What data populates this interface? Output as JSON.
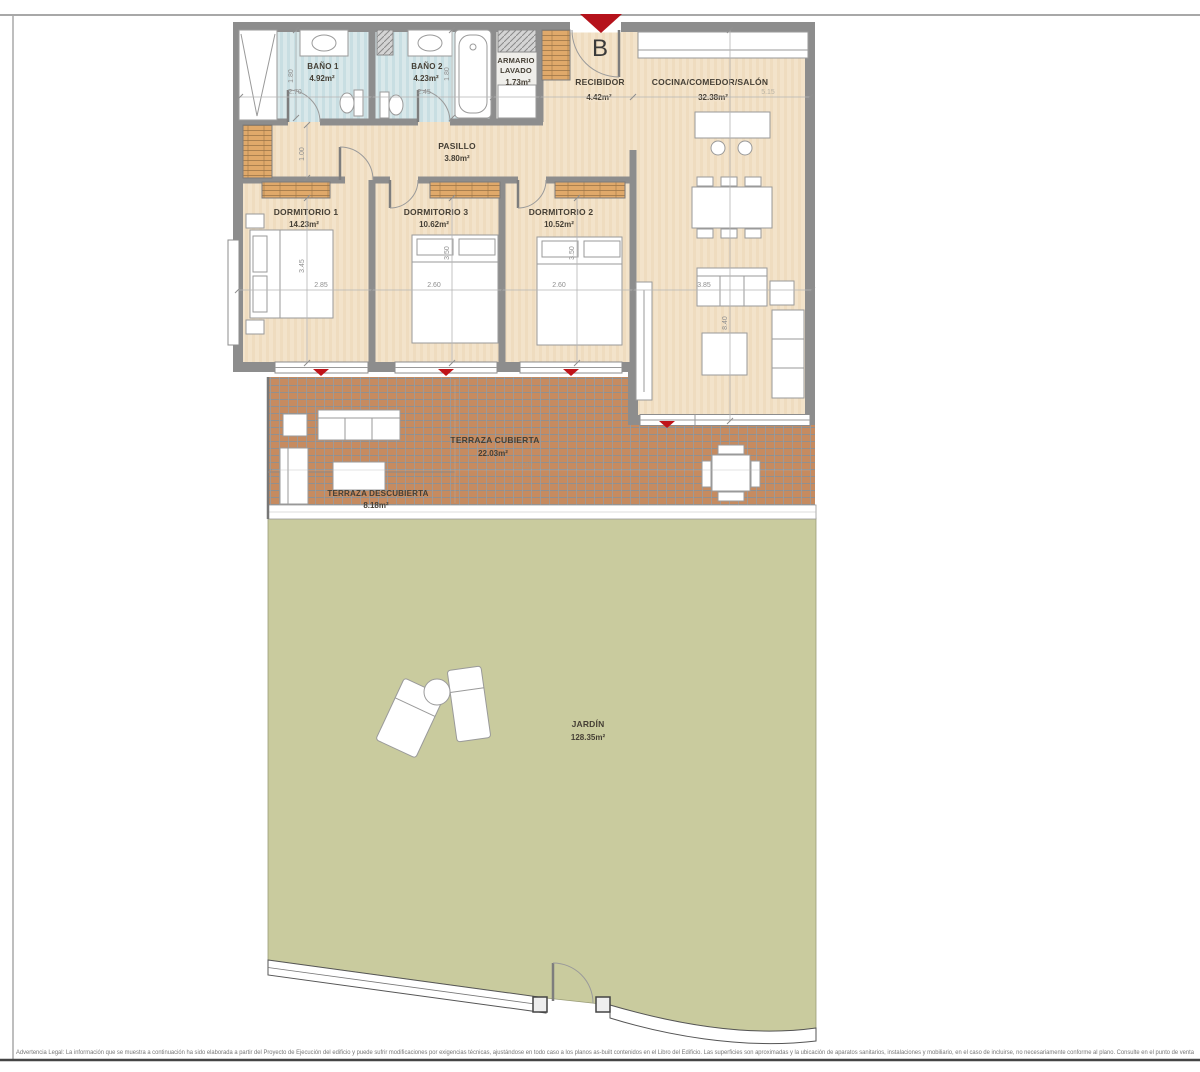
{
  "unit": {
    "marker": "B"
  },
  "rooms": {
    "bano1": {
      "name": "BAÑO 1",
      "area": "4.92m²"
    },
    "bano2": {
      "name": "BAÑO 2",
      "area": "4.23m²"
    },
    "armario_lavado": {
      "name_line1": "ARMARIO",
      "name_line2": "LAVADO",
      "area": "1.73m²"
    },
    "recibidor": {
      "name": "RECIBIDOR",
      "area": "4.42m²"
    },
    "cocina_comedor_salon": {
      "name": "COCINA/COMEDOR/SALÓN",
      "area": "32.38m²"
    },
    "pasillo": {
      "name": "PASILLO",
      "area": "3.80m²"
    },
    "dormitorio1": {
      "name": "DORMITORIO 1",
      "area": "14.23m²"
    },
    "dormitorio3": {
      "name": "DORMITORIO 3",
      "area": "10.62m²"
    },
    "dormitorio2": {
      "name": "DORMITORIO 2",
      "area": "10.52m²"
    },
    "terraza_cubierta": {
      "name": "TERRAZA CUBIERTA",
      "area": "22.03m²"
    },
    "terraza_descubierta": {
      "name": "TERRAZA DESCUBIERTA",
      "area": "8.18m²"
    },
    "jardin": {
      "name": "JARDÍN",
      "area": "128.35m²"
    }
  },
  "dimensions": [
    "2.70",
    "1.80",
    "2.45",
    "1.80",
    "5.15",
    "1.00",
    "3.45",
    "2.85",
    "3.50",
    "2.60",
    "3.50",
    "2.60",
    "3.85",
    "8.40",
    "11.90",
    "1.90"
  ],
  "legal": "Advertencia Legal: La información que se muestra a continuación ha sido elaborada a partir del Proyecto de Ejecución del edificio y puede sufrir modificaciones por exigencias técnicas, ajustándose en todo caso a los planos as-built contenidos en el Libro del Edificio. Las superficies son aproximadas y la ubicación de aparatos sanitarios, instalaciones y mobiliario, en el caso de incluirse, no necesariamente conforme al plano. Consulte en el punto de venta",
  "colors": {
    "wall": "#8d8d8d",
    "wood_floor": "#f3e3ca",
    "bath_floor": "#d9e8ea",
    "terrace_brick": "#c68b60",
    "garden_green": "#c9cb9e",
    "arrow_red": "#c01318"
  }
}
